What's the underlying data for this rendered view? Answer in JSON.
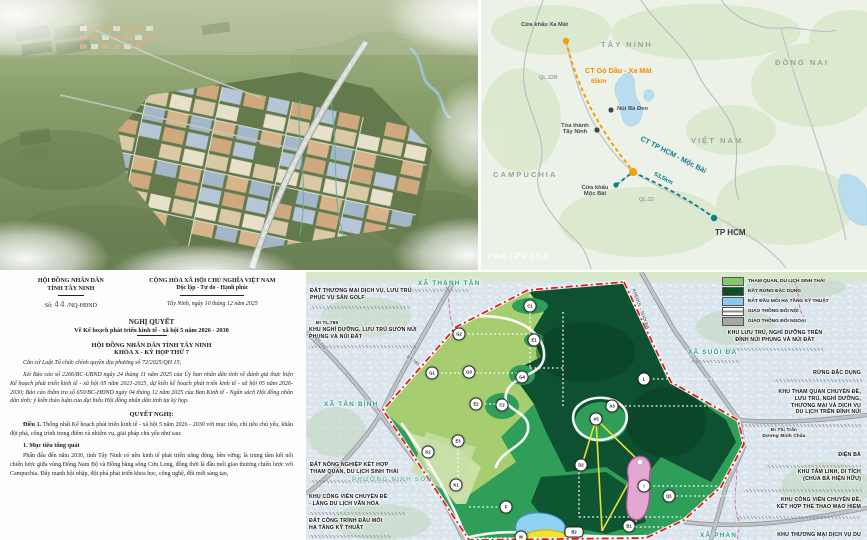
{
  "colors": {
    "accent_orange": "#f28c00",
    "accent_teal": "#0f7d87",
    "boundary_red": "#e11b22",
    "forest_dark": "#0d5130",
    "eco_green": "#a6cd6f",
    "water_blue": "#8fd2f2",
    "commune_teal": "#2f9d8a"
  },
  "doc": {
    "org_line1": "HỘI ĐỒNG NHÂN DÂN",
    "org_line2": "TỈNH TÂY NINH",
    "number_prefix": "Số:",
    "number_value": "44",
    "number_suffix": "/NQ-HĐND",
    "national_line1": "CỘNG HÒA XÃ HỘI CHỦ NGHĨA VIỆT NAM",
    "national_line2": "Độc lập - Tự do - Hạnh phúc",
    "dateline": "Tây Ninh, ngày 10 tháng 12 năm 2025",
    "title": "NGHỊ QUYẾT",
    "subtitle": "Về Kế hoạch phát triển kinh tế - xã hội 5 năm 2026 - 2030",
    "body_org": "HỘI ĐỒNG NHÂN DÂN TỈNH TÂY NINH",
    "session": "KHÓA X - KỲ HỌP THỨ 7",
    "legal_basis": "Căn cứ Luật Tổ chức chính quyền địa phương số 72/2025/QH 15;",
    "report_paragraph": "Xét Báo cáo số 2266/BC-UBND ngày 24 tháng 11 năm 2025 của Ủy ban nhân dân tỉnh về đánh giá thực hiện Kế hoạch phát triển kinh tế - xã hội 05 năm 2021-2025, dự kiến kế hoạch phát triển kinh tế - xã hội 05 năm 2026-2030; Báo cáo thẩm tra số 650/BC-HĐND ngày 04 tháng 12 năm 2025 của Ban Kinh tế - Ngân sách Hội đồng nhân dân tỉnh; ý kiến thảo luận của đại biểu Hội đồng nhân dân tỉnh tại kỳ họp.",
    "resolve_heading": "QUYẾT NGHỊ:",
    "article1_lead": "Điều 1.",
    "article1_rest": " Thống nhất Kế hoạch phát triển kinh tế - xã hội 5 năm 2026 - 2030 với mục tiêu, chỉ tiêu chủ yếu, khâu đột phá, công trình trọng điểm và nhiệm vụ, giải pháp chủ yếu như sau:",
    "section1_heading": "1. Mục tiêu tổng quát",
    "section1_paragraph": "Phấn đấu đến năm 2030, tỉnh Tây Ninh có nền kinh tế phát triển năng động, bền vững; là trung tâm kết nối chiến lược giữa vùng Đông Nam Bộ và Đồng bằng sông Cửu Long, đồng thời là đầu mối giao thương chiến lược với Campuchia. Đẩy mạnh hội nhập, đột phá phát triển khoa học, công nghệ, đổi mới sáng tạo,"
  },
  "route": {
    "labels": [
      {
        "t": "Cửa khẩu Xa Mát",
        "x": 40,
        "y": 22,
        "c": "place",
        "name": "label-cua-khau-xa-mat"
      },
      {
        "t": "TÂY NINH",
        "x": 120,
        "y": 40,
        "c": "region",
        "name": "label-tay-ninh"
      },
      {
        "t": "ĐỒNG NAI",
        "x": 294,
        "y": 58,
        "c": "region",
        "name": "label-dong-nai"
      },
      {
        "t": "CT Gò Dầu - Xa Mát",
        "x": 104,
        "y": 66,
        "c": "hw-orange",
        "name": "label-ct-go-dau-xa-mat"
      },
      {
        "t": "65km",
        "x": 110,
        "y": 79,
        "c": "hw-orange small",
        "name": "label-65km"
      },
      {
        "t": "QL.22B",
        "x": 58,
        "y": 75,
        "c": "road",
        "name": "label-ql22b"
      },
      {
        "t": "Núi Bà Đen",
        "x": 136,
        "y": 106,
        "c": "place",
        "name": "label-nui-ba-den"
      },
      {
        "t": "Tòa thành\nTây Ninh",
        "x": 74,
        "y": 123,
        "w": 40,
        "c": "place center",
        "name": "label-toa-thanh-tay-ninh"
      },
      {
        "t": "VIỆT NAM",
        "x": 210,
        "y": 136,
        "c": "region",
        "name": "label-viet-nam"
      },
      {
        "t": "CAMPUCHIA",
        "x": 12,
        "y": 170,
        "c": "region",
        "name": "label-campuchia"
      },
      {
        "t": "CT TP HCM - Mộc Bài",
        "x": 156,
        "y": 150,
        "r": 27,
        "c": "hw-teal",
        "name": "label-ct-tphcm-moc-bai"
      },
      {
        "t": "53,5km",
        "x": 172,
        "y": 176,
        "r": 27,
        "c": "hw-teal small",
        "name": "label-53-5km"
      },
      {
        "t": "Cửa khẩu\nMộc Bài",
        "x": 94,
        "y": 185,
        "w": 40,
        "c": "place center",
        "name": "label-cua-khau-moc-bai"
      },
      {
        "t": "QL.22",
        "x": 158,
        "y": 197,
        "c": "road",
        "name": "label-ql22"
      },
      {
        "t": "TP HCM",
        "x": 234,
        "y": 228,
        "c": "city",
        "name": "label-tp-hcm"
      },
      {
        "t": "VNEXPRESS",
        "x": 6,
        "y": 252,
        "c": "wm",
        "name": "vnexpress-watermark"
      }
    ]
  },
  "zoning": {
    "legend": [
      {
        "t": "THAM QUAN, DU LỊCH SINH THÁI",
        "sw": "#85c76a",
        "x": 416,
        "y": 5
      },
      {
        "t": "ĐẤT RỪNG ĐẶC DỤNG",
        "sw": "#0b4f24",
        "x": 416,
        "y": 15
      },
      {
        "t": "ĐẤT ĐẦU MỐI HẠ TẦNG KỸ THUẬT",
        "sw": "#86ccf0",
        "x": 416,
        "y": 25
      },
      {
        "t": "GIAO THÔNG ĐỐI NỘI",
        "sw": "line",
        "x": 416,
        "y": 35
      },
      {
        "t": "GIAO THÔNG ĐỐI NGOẠI",
        "sw": "#a7a7a7",
        "x": 416,
        "y": 45
      }
    ],
    "labels": [
      {
        "t": "ĐẤT THƯƠNG MẠI DỊCH VỤ, LƯU TRÚ\nPHỤC VỤ SÂN GOLF",
        "x": 4,
        "y": 16,
        "c": "zl",
        "name": "label-dat-thuong-mai-san-golf"
      },
      {
        "t": "ĐI TL.785",
        "x": 10,
        "y": 48,
        "c": "zl tiny",
        "name": "label-di-tl785"
      },
      {
        "t": "KHU NGHỈ DƯỠNG, LƯU TRÚ SƯỜN NÚI\nPHỤNG VÀ NÚI ĐẤT",
        "x": 3,
        "y": 55,
        "c": "zl",
        "name": "label-khu-nghi-duong-suon-nui"
      },
      {
        "t": "ĐẤT NÔNG NGHIỆP KẾT HỢP\nTHAM QUAN, DU LỊCH SINH THÁI",
        "x": 4,
        "y": 190,
        "c": "zl",
        "name": "label-dat-nong-nghiep"
      },
      {
        "t": "KHU CÔNG VIÊN CHUYÊN ĐỀ\n- LÀNG DU LỊCH VĂN HÓA",
        "x": 3,
        "y": 222,
        "c": "zl",
        "name": "label-cong-vien-lang-du-lich"
      },
      {
        "t": "ĐẤT CÔNG TRÌNH ĐẦU MỐI\nHẠ TẦNG KỸ THUẬT",
        "x": 3,
        "y": 246,
        "c": "zl",
        "name": "label-dat-cong-trinh-dau-moi"
      },
      {
        "t": "XÃ THẠNH TÂN",
        "x": 112,
        "y": 8,
        "c": "commune",
        "name": "label-xa-thanh-tan"
      },
      {
        "t": "XÃ TÂN BÌNH",
        "x": 18,
        "y": 129,
        "c": "commune",
        "name": "label-xa-tan-binh"
      },
      {
        "t": "PHƯỜNG NINH SƠN",
        "x": 46,
        "y": 204,
        "c": "commune faint",
        "name": "label-phuong-ninh-son"
      },
      {
        "t": "XÃ SUỐI ĐÁ",
        "x": 382,
        "y": 77,
        "c": "commune",
        "name": "label-xa-suoi-da"
      },
      {
        "t": "XÃ PHAN",
        "x": 394,
        "y": 260,
        "c": "commune",
        "name": "label-xa-phan"
      },
      {
        "t": "KHU LƯU TRÚ, NGHỈ DƯỠNG TRÊN\nĐỈNH NÚI PHỤNG VÀ NÚI ĐẤT",
        "x": 418,
        "y": 58,
        "w": 102,
        "c": "zl center",
        "name": "label-khu-luu-tru-dinh-nui"
      },
      {
        "t": "RỪNG ĐẶC DỤNG",
        "x": 455,
        "y": 98,
        "w": 100,
        "c": "zl right",
        "name": "label-rung-dac-dung"
      },
      {
        "t": "KHU THAM QUAN CHUYÊN ĐỀ,\nLƯU TRÚ, NGHỈ DƯỠNG,\nTHƯƠNG MẠI VÀ DỊCH VỤ\nDU LỊCH TRÊN ĐỈNH NÚI",
        "x": 430,
        "y": 117,
        "w": 125,
        "c": "zl right",
        "name": "label-khu-tham-quan-chuyen-de"
      },
      {
        "t": "Đi Thị Trấn\nDương Minh Châu",
        "x": 448,
        "y": 155,
        "w": 60,
        "c": "zl tiny center",
        "name": "label-di-thi-tran-duong-minh-chau"
      },
      {
        "t": "ĐIỆN BÀ",
        "x": 515,
        "y": 180,
        "w": 40,
        "c": "zl right",
        "name": "label-dien-ba"
      },
      {
        "t": "KHU TÂM LINH, DI TÍCH\n(CHÙA BÀ HIỆN HỮU)",
        "x": 440,
        "y": 197,
        "w": 115,
        "c": "zl right",
        "name": "label-khu-tam-linh"
      },
      {
        "t": "KHU CÔNG VIÊN CHUYÊN ĐỀ,\nKẾT HỢP THỂ THAO MẠO HIỂM",
        "x": 430,
        "y": 225,
        "w": 125,
        "c": "zl right",
        "name": "label-cong-vien-the-thao-mao-hiem"
      },
      {
        "t": "KHU THƯƠNG MẠI DỊCH VỤ DU",
        "x": 430,
        "y": 260,
        "w": 125,
        "c": "zl right",
        "name": "label-khu-thuong-mai-dich-vu"
      },
      {
        "t": "ĐT.785",
        "x": 103,
        "y": 82,
        "r": 38,
        "c": "roadlbl",
        "name": "label-dt785"
      },
      {
        "t": "ĐT.793",
        "x": 12,
        "y": 64,
        "r": 50,
        "c": "roadlbl",
        "name": "label-dt793"
      },
      {
        "t": "KHEDOL - SUỐI ĐÁ",
        "x": 330,
        "y": 16,
        "r": 70,
        "c": "roadlbl",
        "name": "label-khedol-suoi-da"
      }
    ],
    "markers": [
      {
        "t": "C1",
        "x": 224,
        "y": 34,
        "c": "marker"
      },
      {
        "t": "E1",
        "x": 228,
        "y": 68,
        "c": "marker"
      },
      {
        "t": "G2",
        "x": 153,
        "y": 62,
        "c": "marker"
      },
      {
        "t": "G1",
        "x": 126,
        "y": 101,
        "c": "marker"
      },
      {
        "t": "G3",
        "x": 163,
        "y": 100,
        "c": "marker"
      },
      {
        "t": "G4",
        "x": 216,
        "y": 105,
        "c": "marker"
      },
      {
        "t": "L",
        "x": 338,
        "y": 107,
        "c": "marker"
      },
      {
        "t": "E2",
        "x": 170,
        "y": 132,
        "c": "marker"
      },
      {
        "t": "C2",
        "x": 196,
        "y": 133,
        "c": "marker"
      },
      {
        "t": "A3",
        "x": 306,
        "y": 134,
        "c": "marker"
      },
      {
        "t": "A5",
        "x": 290,
        "y": 147,
        "c": "marker"
      },
      {
        "t": "E3",
        "x": 152,
        "y": 169,
        "c": "marker"
      },
      {
        "t": "K2",
        "x": 122,
        "y": 180,
        "c": "marker"
      },
      {
        "t": "D2",
        "x": 275,
        "y": 193,
        "c": "marker"
      },
      {
        "t": "K1",
        "x": 150,
        "y": 213,
        "c": "marker"
      },
      {
        "t": "I",
        "x": 338,
        "y": 214,
        "c": "marker"
      },
      {
        "t": "Q1",
        "x": 363,
        "y": 224,
        "c": "marker"
      },
      {
        "t": "F",
        "x": 200,
        "y": 235,
        "c": "marker"
      },
      {
        "t": "B1",
        "x": 323,
        "y": 254,
        "c": "marker"
      },
      {
        "t": "M",
        "x": 215,
        "y": 265,
        "c": "marker"
      },
      {
        "t": "B2",
        "x": 268,
        "y": 260,
        "c": "marker pill"
      }
    ],
    "hatches": [
      {
        "x": 4,
        "y": 34,
        "w": 100
      },
      {
        "x": 3,
        "y": 73,
        "w": 107
      },
      {
        "x": 92,
        "y": 17,
        "w": 72
      },
      {
        "x": 4,
        "y": 208,
        "w": 97
      },
      {
        "x": 3,
        "y": 240,
        "w": 97
      },
      {
        "x": 3,
        "y": 263,
        "w": 82
      },
      {
        "x": 418,
        "y": 76,
        "w": 100
      },
      {
        "x": 468,
        "y": 107,
        "w": 88
      },
      {
        "x": 430,
        "y": 152,
        "w": 125
      },
      {
        "x": 460,
        "y": 193,
        "w": 95
      },
      {
        "x": 438,
        "y": 217,
        "w": 118
      },
      {
        "x": 428,
        "y": 244,
        "w": 127
      },
      {
        "x": 384,
        "y": 88,
        "w": 50
      }
    ]
  }
}
